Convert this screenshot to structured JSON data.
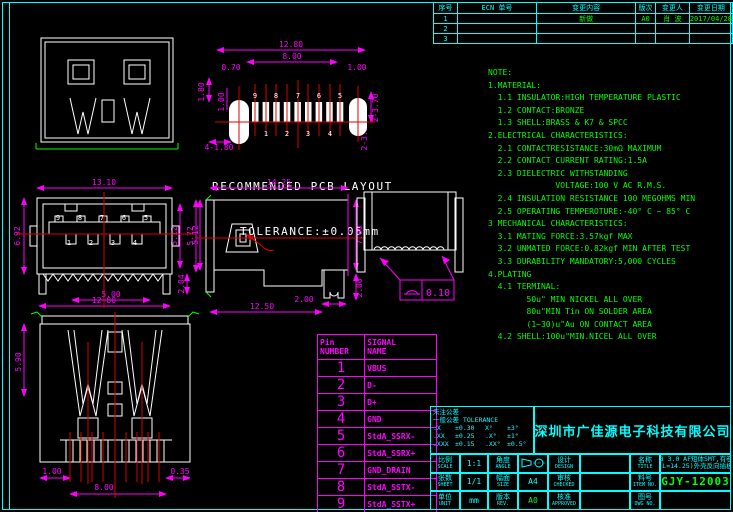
{
  "colors": {
    "cyan": "#00ffff",
    "magenta": "#ff00ff",
    "green": "#00ff00",
    "white": "#ffffff",
    "red": "#dd0000",
    "bg": "#000000"
  },
  "revision_table": {
    "headers": [
      "序号",
      "ECN 单号",
      "变更内容",
      "版次",
      "变更人",
      "变更日期"
    ],
    "rows": [
      [
        "1",
        "",
        "新做",
        "A0",
        "肖 波",
        "2017/04/28"
      ],
      [
        "2",
        "",
        "",
        "",
        "",
        ""
      ],
      [
        "3",
        "",
        "",
        "",
        "",
        ""
      ]
    ]
  },
  "notes": {
    "lines": [
      "NOTE:",
      "1.MATERIAL:",
      "  1.1 INSULATOR:HIGH TEMPERATURE PLASTIC",
      "  1.2 CONTACT:BRONZE",
      "  1.3 SHELL:BRASS & K7 & SPCC",
      "2.ELECTRICAL CHARACTERISTICS:",
      "  2.1 CONTACTRESISTANCE:30mΩ MAXIMUM",
      "  2.2 CONTACT CURRENT RATING:1.5A",
      "  2.3 DIELECTRIC WITHSTANDING",
      "              VOLTAGE:100 V AC R.M.S.",
      "  2.4 INSULATION RESISTANCE 100 MEGOHMS MIN",
      "  2.5 OPERATING TEMPEROTURE:-40° C ~ 85° C",
      "3 MECHANICAL CHARACTERISTICS:",
      "  3.1 MATING FORCE:3.57kgf MAX",
      "  3.2 UNMATED FORCE:0.82kgf MIN AFTER TEST",
      "  3.3 DURABILITY MANDATORY:5,000 CYCLES",
      "4.PLATING",
      "  4.1 TERMINAL:",
      "        50u\" MIN NICKEL ALL OVER",
      "        80u\"MIN Tin ON SOLDER AREA",
      "        (1~30)u\"Au ON CONTACT AREA",
      "  4.2 SHELL:100u\"MIN.NICEL ALL OVER"
    ]
  },
  "pcb": {
    "caption1": "RECOMMENDED PCB LAYOUT",
    "caption2": "TOLERANCE:±0.05mm",
    "dims": {
      "overall": "12.80",
      "span": "8.00",
      "offset": "0.70",
      "end": "1.00",
      "v1": "1.80",
      "v2": "1.00",
      "holes": "4-1.80",
      "r1": "2-3.70",
      "r2": "2-3.50"
    },
    "pins_top": [
      "9",
      "8",
      "7",
      "6",
      "5"
    ],
    "pins_bottom": [
      "1",
      "2",
      "3",
      "4"
    ]
  },
  "front": {
    "dims": {
      "width": "13.10",
      "h_left": "6.92",
      "h_right": "5.12",
      "h_right2": "5.72",
      "bottom": "12.80",
      "leg": "2.04"
    },
    "pins_top": [
      "9",
      "8",
      "7",
      "6",
      "5"
    ],
    "pins_bottom": [
      "1",
      "2",
      "3",
      "4"
    ]
  },
  "side": {
    "dims": {
      "length": "14.25",
      "h_left": "5.12",
      "h_right": "7.00",
      "leg_h": "2.00",
      "leg_w": "2.00",
      "bottom": "12.50"
    }
  },
  "rear": {
    "flatness": "0.10"
  },
  "bottomview": {
    "dims": {
      "top": "5.00",
      "left": "5.90",
      "b_left": "1.00",
      "b_right": "0.35",
      "b_span": "8.00"
    }
  },
  "pin_table": {
    "header": {
      "col1a": "Pin",
      "col1b": "NUMBER",
      "col2a": "SIGNAL",
      "col2b": "NAME"
    },
    "rows": [
      [
        "1",
        "VBUS"
      ],
      [
        "2",
        "D-"
      ],
      [
        "3",
        "D+"
      ],
      [
        "4",
        "GND"
      ],
      [
        "5",
        "StdA_SSRX-"
      ],
      [
        "6",
        "StdA_SSRX+"
      ],
      [
        "7",
        "GND_DRAIN"
      ],
      [
        "8",
        "StdA_SSTX-"
      ],
      [
        "9",
        "StdA_SSTX+"
      ],
      [
        "Shell",
        "Shield"
      ]
    ]
  },
  "title_block": {
    "company": "深圳市广佳源电子科技有限公司",
    "tolerance": {
      "line1": "未注公差",
      "line2": "一般公差 TOLERANCE",
      "rows": [
        [
          ".X",
          "±0.30",
          "X°",
          "±3°"
        ],
        [
          ".XX",
          "±0.25",
          ".X°",
          "±1°"
        ],
        [
          ".XXX",
          "±0.15",
          ".XX°",
          "±0.5°"
        ]
      ]
    },
    "fields": {
      "scale_label": "比例",
      "scale_label_en": "SCALE",
      "scale": "1:1",
      "angle_label": "角度",
      "angle_label_en": "ANGLE",
      "design_label": "设计",
      "design_label_en": "DESIGN",
      "pages_label": "张数",
      "pages_label_en": "SHEET",
      "pages": "1/1",
      "size_label": "幅面",
      "size_label_en": "SIZE",
      "size": "A4",
      "check_label": "审核",
      "check_label_en": "CHECKED",
      "unit_label": "单位",
      "unit_label_en": "UNIT",
      "unit": "mm",
      "rev_label": "版本",
      "rev_label_en": "REV.",
      "rev": "A0",
      "approve_label": "核准",
      "approve_label_en": "APPROVED",
      "title_label": "名称",
      "title_label_en": "TITLE",
      "item_label": "料号",
      "item_label_en": "ITEM NO.",
      "dwg_label": "图号",
      "dwg_label_en": "DWG NO.",
      "title1": "USB 3.0 AF短体SMT,有卷边",
      "title2": "(L=14.25)外壳反向插板",
      "item_no": "GJY-12003"
    }
  }
}
